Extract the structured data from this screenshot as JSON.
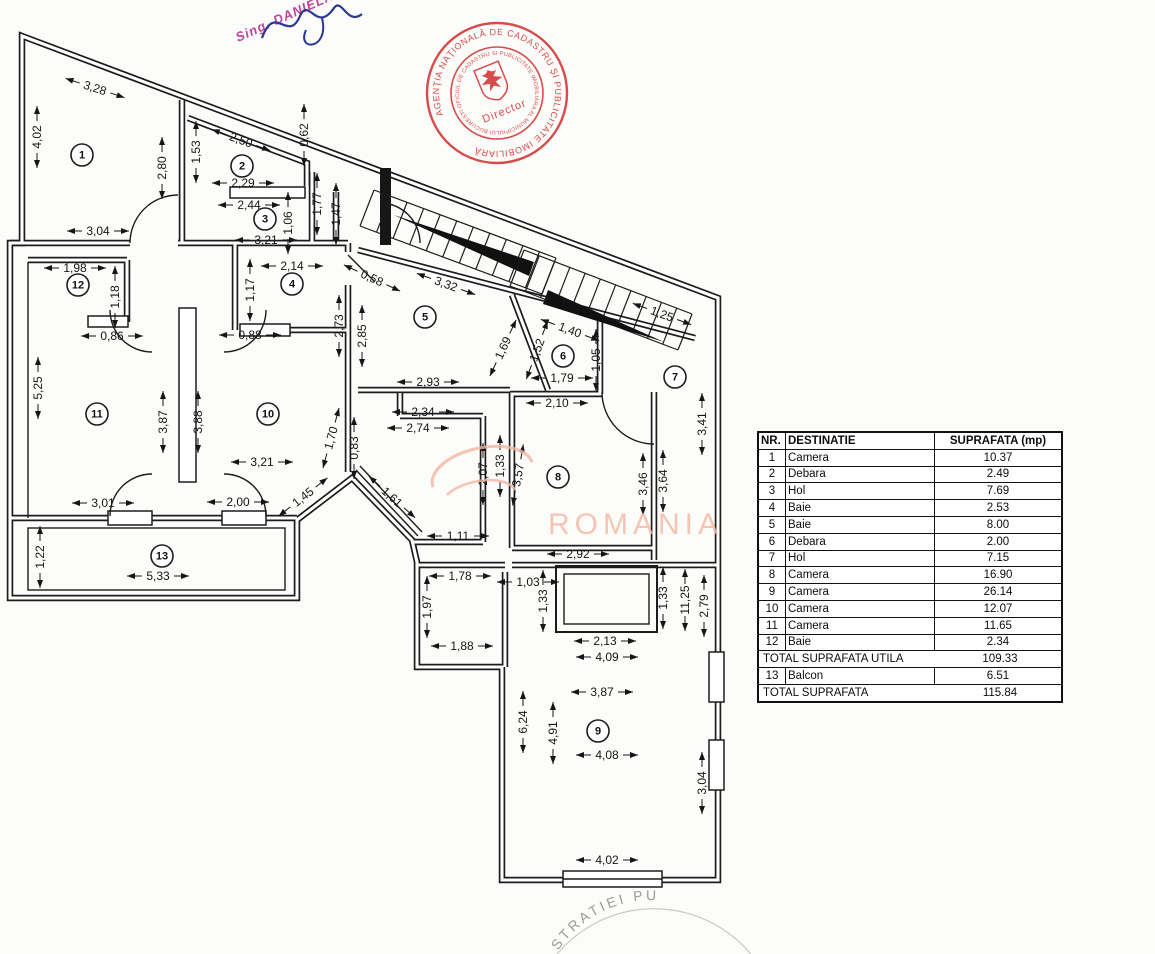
{
  "signature": {
    "stamp_text": "Sing. DANIELA"
  },
  "seal": {
    "outer_text": "AGENŢIA NAŢIONALĂ DE CADASTRU ŞI PUBLICITATE IMOBILIARĂ",
    "inner_text": "OFICIUL DE CADASTRU SI PUBLICITATE IMOBILIARA AL MUNICIPIULUI BUCURESTI ★",
    "center_text": "Director",
    "color": "#d23434"
  },
  "watermark": {
    "text": "ROMANIA",
    "color": "#f4b8a2"
  },
  "bottom_stamp": {
    "visible_text": "STRATIEI PU",
    "color": "#8a8a8a"
  },
  "table": {
    "headers": [
      "NR.",
      "DESTINATIE",
      "SUPRAFATA (mp)"
    ],
    "rows": [
      [
        "1",
        "Camera",
        "10.37"
      ],
      [
        "2",
        "Debara",
        "2.49"
      ],
      [
        "3",
        "Hol",
        "7.69"
      ],
      [
        "4",
        "Baie",
        "2.53"
      ],
      [
        "5",
        "Baie",
        "8.00"
      ],
      [
        "6",
        "Debara",
        "2.00"
      ],
      [
        "7",
        "Hol",
        "7.15"
      ],
      [
        "8",
        "Camera",
        "16.90"
      ],
      [
        "9",
        "Camera",
        "26.14"
      ],
      [
        "10",
        "Camera",
        "12.07"
      ],
      [
        "11",
        "Camera",
        "11.65"
      ],
      [
        "12",
        "Baie",
        "2.34"
      ]
    ],
    "subtotal": {
      "label": "TOTAL SUPRAFATA UTILA",
      "value": "109.33"
    },
    "balcony_row": [
      "13",
      "Balcon",
      "6.51"
    ],
    "total": {
      "label": "TOTAL SUPRAFATA",
      "value": "115.84"
    }
  },
  "floor_plan": {
    "rooms": [
      {
        "n": "1",
        "x": 82,
        "y": 155
      },
      {
        "n": "2",
        "x": 242,
        "y": 166
      },
      {
        "n": "3",
        "x": 265,
        "y": 219
      },
      {
        "n": "4",
        "x": 292,
        "y": 284
      },
      {
        "n": "5",
        "x": 425,
        "y": 317
      },
      {
        "n": "6",
        "x": 563,
        "y": 356
      },
      {
        "n": "7",
        "x": 675,
        "y": 377
      },
      {
        "n": "8",
        "x": 558,
        "y": 477
      },
      {
        "n": "9",
        "x": 598,
        "y": 731
      },
      {
        "n": "10",
        "x": 268,
        "y": 414
      },
      {
        "n": "11",
        "x": 97,
        "y": 414
      },
      {
        "n": "12",
        "x": 78,
        "y": 285
      },
      {
        "n": "13",
        "x": 162,
        "y": 556
      }
    ],
    "dimensions": [
      {
        "t": "3,28",
        "x": 95,
        "y": 88,
        "r": 18
      },
      {
        "t": "4,02",
        "x": 37,
        "y": 137,
        "r": -90
      },
      {
        "t": "2,80",
        "x": 162,
        "y": 168,
        "r": -90
      },
      {
        "t": "1,53",
        "x": 196,
        "y": 152,
        "r": -90
      },
      {
        "t": "2,50",
        "x": 241,
        "y": 140,
        "r": 20
      },
      {
        "t": "0,62",
        "x": 304,
        "y": 135,
        "r": -90
      },
      {
        "t": "2,29",
        "x": 243,
        "y": 183,
        "r": 0
      },
      {
        "t": "2,44",
        "x": 249,
        "y": 205,
        "r": 0
      },
      {
        "t": "1,06",
        "x": 288,
        "y": 223,
        "r": -90
      },
      {
        "t": "1,77",
        "x": 317,
        "y": 204,
        "r": -90
      },
      {
        "t": "1,47",
        "x": 336,
        "y": 214,
        "r": -90
      },
      {
        "t": "3,04",
        "x": 98,
        "y": 231,
        "r": 0
      },
      {
        "t": "3,21",
        "x": 266,
        "y": 240,
        "r": 0
      },
      {
        "t": "2,14",
        "x": 292,
        "y": 266,
        "r": 0
      },
      {
        "t": "1,17",
        "x": 250,
        "y": 290,
        "r": -90
      },
      {
        "t": "1,98",
        "x": 75,
        "y": 268,
        "r": 0
      },
      {
        "t": "1,18",
        "x": 115,
        "y": 297,
        "r": -90
      },
      {
        "t": "0,86",
        "x": 112,
        "y": 336,
        "r": 0
      },
      {
        "t": "0,88",
        "x": 250,
        "y": 335,
        "r": 0
      },
      {
        "t": "0,58",
        "x": 372,
        "y": 278,
        "r": 25
      },
      {
        "t": "2,73",
        "x": 339,
        "y": 326,
        "r": -90
      },
      {
        "t": "2,85",
        "x": 362,
        "y": 336,
        "r": -90
      },
      {
        "t": "3,32",
        "x": 446,
        "y": 284,
        "r": 20
      },
      {
        "t": "5,25",
        "x": 38,
        "y": 388,
        "r": -90
      },
      {
        "t": "3,87",
        "x": 163,
        "y": 422,
        "r": -90
      },
      {
        "t": "3,88",
        "x": 198,
        "y": 422,
        "r": -90
      },
      {
        "t": "1,69",
        "x": 503,
        "y": 348,
        "r": -65
      },
      {
        "t": "2,93",
        "x": 428,
        "y": 382,
        "r": 0
      },
      {
        "t": "1,40",
        "x": 570,
        "y": 330,
        "r": 20
      },
      {
        "t": "1,52",
        "x": 537,
        "y": 350,
        "r": -70
      },
      {
        "t": "1,05",
        "x": 596,
        "y": 360,
        "r": -90
      },
      {
        "t": "1,79",
        "x": 562,
        "y": 378,
        "r": 0
      },
      {
        "t": "2,10",
        "x": 557,
        "y": 403,
        "r": 0
      },
      {
        "t": "1,25",
        "x": 662,
        "y": 314,
        "r": 20
      },
      {
        "t": "3,41",
        "x": 702,
        "y": 424,
        "r": -90
      },
      {
        "t": "3,21",
        "x": 262,
        "y": 462,
        "r": 0
      },
      {
        "t": "1,70",
        "x": 331,
        "y": 438,
        "r": -75
      },
      {
        "t": "0,83",
        "x": 354,
        "y": 448,
        "r": -90
      },
      {
        "t": "2,34",
        "x": 423,
        "y": 412,
        "r": 0
      },
      {
        "t": "2,74",
        "x": 418,
        "y": 428,
        "r": 0
      },
      {
        "t": "2,07",
        "x": 483,
        "y": 474,
        "r": -90
      },
      {
        "t": "1,33",
        "x": 500,
        "y": 466,
        "r": -90
      },
      {
        "t": "3,57",
        "x": 518,
        "y": 475,
        "r": -80
      },
      {
        "t": "3,46",
        "x": 643,
        "y": 484,
        "r": -90
      },
      {
        "t": "3,64",
        "x": 663,
        "y": 481,
        "r": -90
      },
      {
        "t": "1,45",
        "x": 303,
        "y": 497,
        "r": -38
      },
      {
        "t": "1,61",
        "x": 392,
        "y": 497,
        "r": 42
      },
      {
        "t": "3,01",
        "x": 103,
        "y": 503,
        "r": 0
      },
      {
        "t": "2,00",
        "x": 238,
        "y": 502,
        "r": 0
      },
      {
        "t": "1,11",
        "x": 458,
        "y": 536,
        "r": 0
      },
      {
        "t": "2,92",
        "x": 578,
        "y": 554,
        "r": 0
      },
      {
        "t": "1,22",
        "x": 40,
        "y": 557,
        "r": -90
      },
      {
        "t": "5,33",
        "x": 158,
        "y": 576,
        "r": 0
      },
      {
        "t": "1,78",
        "x": 460,
        "y": 576,
        "r": 0
      },
      {
        "t": "1,03",
        "x": 528,
        "y": 582,
        "r": 0
      },
      {
        "t": "1,33",
        "x": 543,
        "y": 601,
        "r": -90
      },
      {
        "t": "1,33",
        "x": 663,
        "y": 598,
        "r": -90
      },
      {
        "t": "11,25",
        "x": 685,
        "y": 600,
        "r": -90
      },
      {
        "t": "2,79",
        "x": 704,
        "y": 606,
        "r": -90
      },
      {
        "t": "1,97",
        "x": 427,
        "y": 607,
        "r": -90
      },
      {
        "t": "1,88",
        "x": 462,
        "y": 646,
        "r": 0
      },
      {
        "t": "2,13",
        "x": 605,
        "y": 641,
        "r": 0
      },
      {
        "t": "4,09",
        "x": 607,
        "y": 657,
        "r": 0
      },
      {
        "t": "3,87",
        "x": 602,
        "y": 692,
        "r": 0
      },
      {
        "t": "6,24",
        "x": 523,
        "y": 722,
        "r": -90
      },
      {
        "t": "4,91",
        "x": 553,
        "y": 733,
        "r": -90
      },
      {
        "t": "4,08",
        "x": 607,
        "y": 755,
        "r": 0
      },
      {
        "t": "3,04",
        "x": 702,
        "y": 783,
        "r": -90
      },
      {
        "t": "4,02",
        "x": 607,
        "y": 860,
        "r": 0
      }
    ]
  }
}
